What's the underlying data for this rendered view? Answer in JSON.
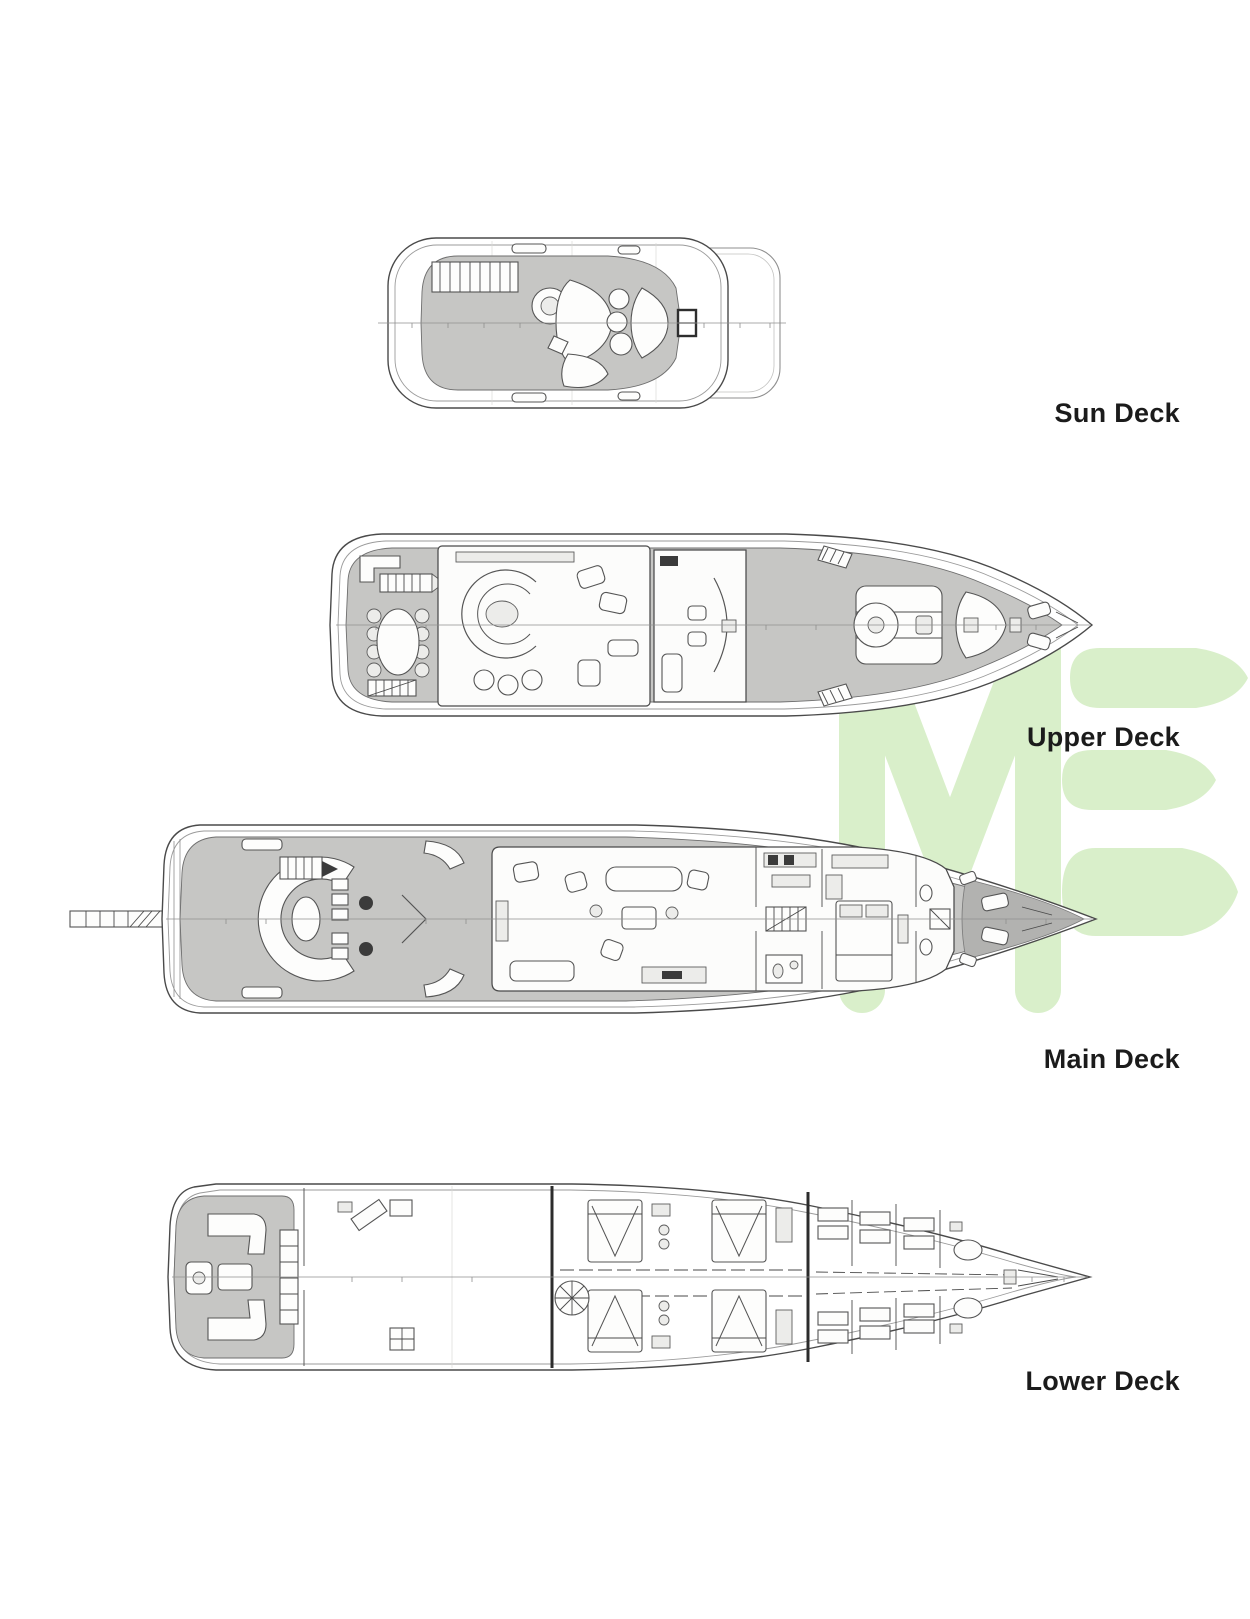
{
  "page": {
    "title": "Yacht deck plans",
    "background": "#ffffff"
  },
  "decks": [
    {
      "id": "sun",
      "label": "Sun Deck"
    },
    {
      "id": "upper",
      "label": "Upper Deck"
    },
    {
      "id": "main",
      "label": "Main Deck"
    },
    {
      "id": "lower",
      "label": "Lower Deck"
    }
  ],
  "watermark": {
    "visible_letters": "ME",
    "color": "#d9efca"
  },
  "colors": {
    "label_text": "#1b1b1b",
    "line": "#4a4a4a",
    "deck_gray": "#c6c6c4",
    "deck_gray_dark": "#b2b2b0",
    "hull_white": "#ffffff"
  }
}
